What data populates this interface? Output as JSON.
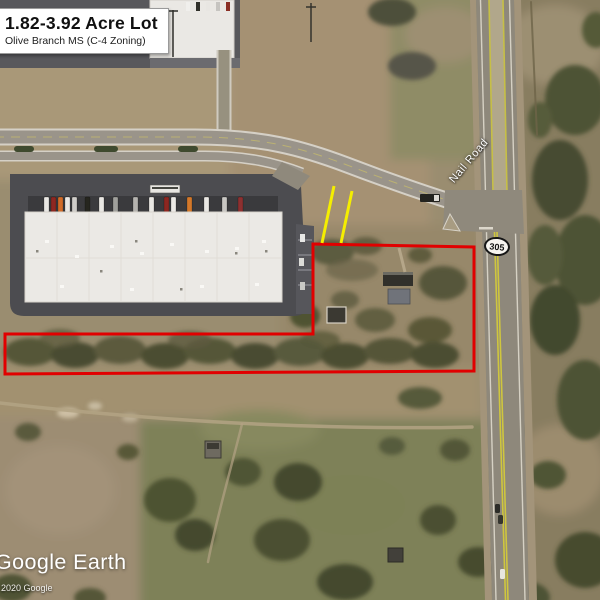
{
  "listing": {
    "title": "1.82-3.92 Acre Lot",
    "subtitle": "Olive Branch MS (C-4 Zoning)"
  },
  "map": {
    "road_label": "Nail Road",
    "route_shield": "305",
    "overlays": {
      "boundary_color": "#e10000",
      "boundary_points": "313,244 474,247 474,371 5,374 5,334 313,334",
      "lot_line_color": "#f5ee00",
      "lot_lines": [
        {
          "x1": 334,
          "y1": 186,
          "x2": 322,
          "y2": 243
        },
        {
          "x1": 352,
          "y1": 191,
          "x2": 341,
          "y2": 243
        }
      ]
    }
  },
  "branding": {
    "logo": "Google Earth",
    "copyright": "2020 Google"
  }
}
